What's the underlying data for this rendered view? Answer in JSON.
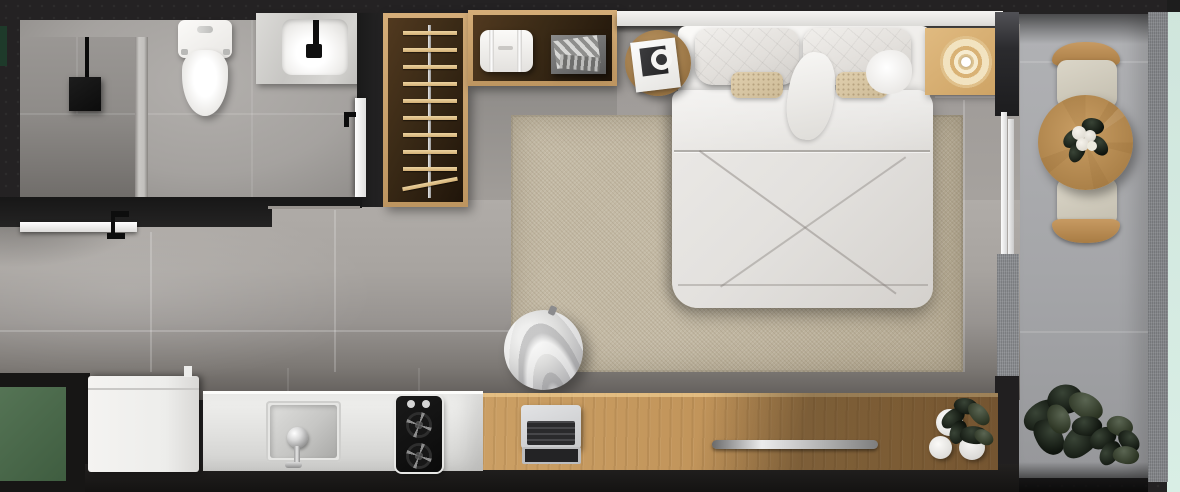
{
  "app": {
    "name": "studio-apartment-floor-plan",
    "view": "top-down 3D render",
    "canvas": {
      "width": 1180,
      "height": 492
    }
  },
  "rooms": [
    {
      "id": "bathroom",
      "label": "Bathroom",
      "items": [
        "walk-in shower",
        "black shower fixture",
        "toilet",
        "marble vanity with basin and black faucet",
        "white door with black handle",
        "half-wall divider"
      ]
    },
    {
      "id": "entry",
      "label": "Entry",
      "items": [
        "white entrance door with black handle",
        "green doormat"
      ]
    },
    {
      "id": "wardrobe",
      "label": "Open wardrobe (L-shaped)",
      "items": [
        "hanging rail",
        "ten wooden hangers",
        "white laundry hamper",
        "gray storage box with folded clothes"
      ]
    },
    {
      "id": "bedroom",
      "label": "Bedroom / living area",
      "items": [
        "white headboard shelf",
        "double bed with white duvet",
        "two quilted pillows",
        "two white pillows",
        "two beige accent pillows",
        "beige area rug",
        "knitted gray pouf",
        "round wooden side table with book and headphones",
        "square rattan bedside mat with concentric tray"
      ]
    },
    {
      "id": "kitchen",
      "label": "Kitchenette",
      "items": [
        "white refrigerator",
        "stainless counter",
        "square sink with chrome faucet",
        "black two-burner stove"
      ]
    },
    {
      "id": "desk",
      "label": "Wooden desk counter",
      "items": [
        "open laptop",
        "recessed metal groove",
        "two white cups",
        "small potted plant"
      ]
    },
    {
      "id": "balcony",
      "label": "Balcony",
      "items": [
        "white sliding glass door",
        "round wooden table",
        "white flower centerpiece",
        "two chairs with wooden backs",
        "large potted plant",
        "small potted plant",
        "speckled outer ledge",
        "mint exterior strip"
      ]
    }
  ],
  "palette": {
    "wall": "#242223",
    "floor": "#a8a4a0",
    "bathroom_tile": "#a5a29f",
    "rug": "#bfb5a0",
    "wood_light": "#c59a60",
    "wardrobe_interior": "#3a2a16",
    "wardrobe_frame": "#c8a26e",
    "hanger": "#e2c592",
    "white_fixture": "#f4f3f1",
    "stainless": "#e6e6e4",
    "stove": "#0f0f0f",
    "balcony_floor": "#a8a9ac",
    "balcony_ledge": "#85878b",
    "exterior_mint": "#d6ebe2",
    "doormat_green": "#4e6f50",
    "plant": "#141a13"
  }
}
